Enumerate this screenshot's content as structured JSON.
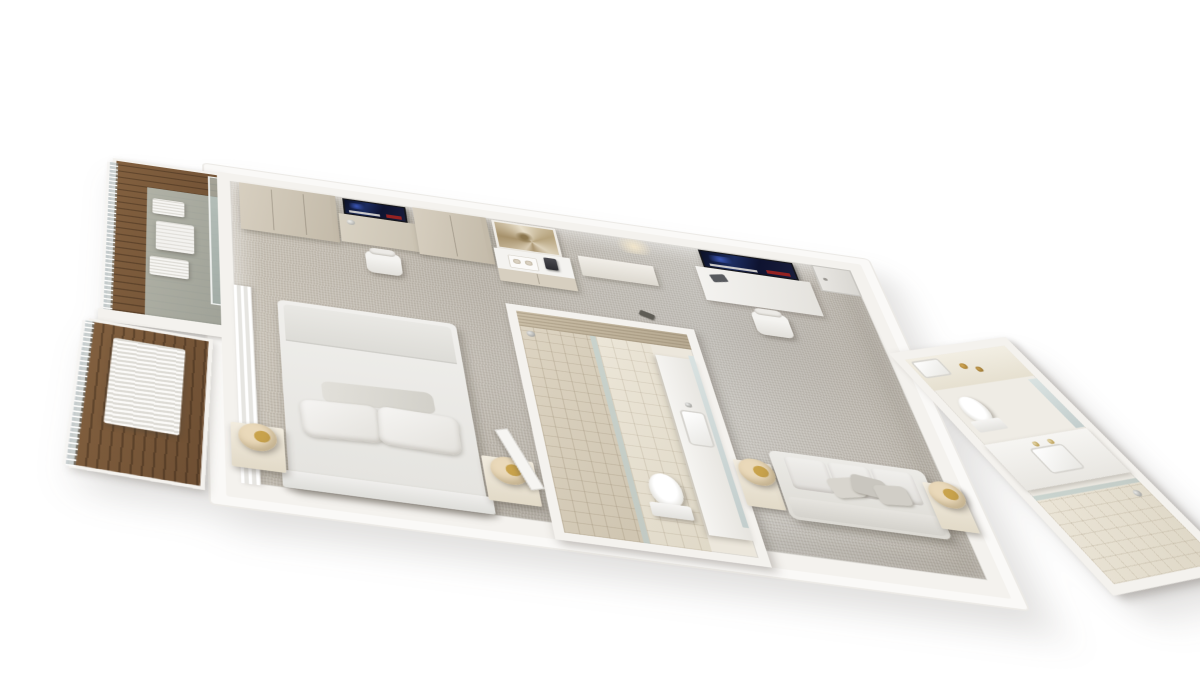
{
  "meta": {
    "type": "3d-isometric-floorplan-render",
    "scene_label": "3D cutaway floor plan of a long hotel suite with two balconies, bedroom, two bathrooms and living area"
  },
  "colors": {
    "page_bg": "#ffffff",
    "slab": "#faf9f7",
    "wall": "#f4f2ee",
    "carpet_a": "#c8c1b5",
    "carpet_b": "#b9b3a9",
    "carpet_c": "#c7c4be",
    "wood_a": "#82603f",
    "wood_b": "#6e4f33",
    "cabinet_a": "#d7cfc0",
    "cabinet_b": "#c3baa9",
    "lamp_cream": "#ead9ba",
    "lamp_gold": "#c9a34c",
    "stone_a": "#c9bda6",
    "stone_b": "#b7aa92",
    "tv_frame": "#15161a",
    "tv_red": "#a32420"
  },
  "labels": {
    "scene": "isometric 3D floor plan render of hotel suite",
    "balcony_upper": "balcony with outdoor table and chairs on wood deck",
    "balcony_lower": "second balcony deck with slatted lounger",
    "glass_door": "sliding glass balcony door",
    "curtains": "sheer curtains along glass wall",
    "wardrobe_1": "wardrobe cabinet",
    "wardrobe_2": "wardrobe cabinet",
    "tv_1": "wall-mounted TV over bedroom desk",
    "desk_1": "bedroom desk",
    "chair_1": "white desk chair",
    "artwork": "nautilus shell artwork",
    "minibar": "minibar console with tray and coffee machine",
    "tray": "service tray with cups",
    "coffee_machine": "coffee machine",
    "bench_1": "low bench",
    "bed": "king bed with duvet",
    "pillows": "bed pillows",
    "headboard": "headboard",
    "nightstand_left": "left nightstand with sphere lamp",
    "nightstand_right": "right nightstand with sphere lamp",
    "sphere_lamp": "cream sphere lamp with gold interior",
    "slippers": "slippers on carpet",
    "bath_central": "central bathroom with walk-in shower, toilet and vanity",
    "accent_wall": "stone mosaic accent wall",
    "shower": "walk-in shower with tiled floor",
    "toilet": "toilet",
    "vanity": "vanity counter with sink and mirror",
    "bath_door": "open bathroom door",
    "tv_2": "wall-mounted TV in living area",
    "desk_2": "living area work desk",
    "chair_2": "white desk chair",
    "entry_door": "suite entry door",
    "sofa": "three-seat sofa with scatter cushions",
    "side_table_left": "sofa side table with sphere lamp",
    "side_table_right": "sofa side table with sphere lamp",
    "bath_right": "angled en-suite bathroom with vanity, toilet and shower",
    "br_vanity": "vanity with sink and gold faucets",
    "br_toilet": "toilet",
    "br_shower": "glass-enclosed shower",
    "br_mirror": "mirror panel"
  }
}
